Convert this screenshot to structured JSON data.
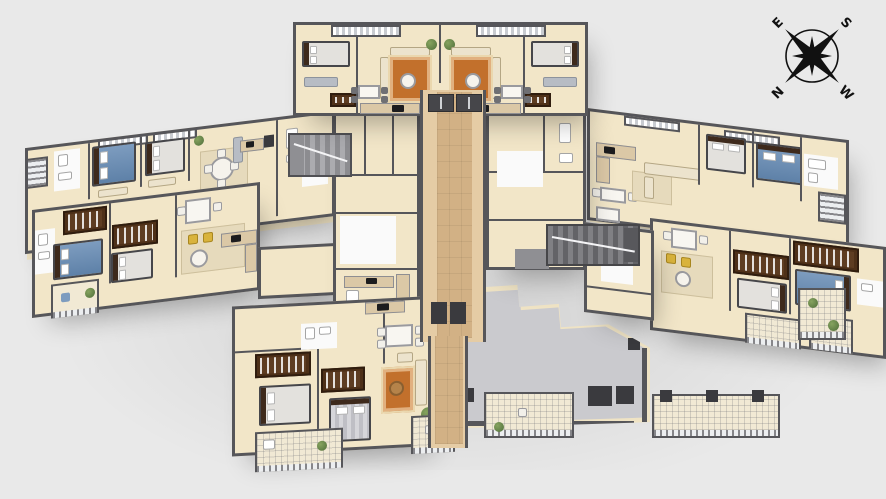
{
  "compass": {
    "north": "N",
    "east": "E",
    "south": "S",
    "west": "W"
  },
  "palette": {
    "bg": "#e9e9e9",
    "wall": "#56565a",
    "wall-dark": "#3a3a3e",
    "floor": "#f2e6c8",
    "corridor": "#e5cca5",
    "runner": "#d2b185",
    "terrace": "#cacace",
    "balcony": "#f1e9d4",
    "white-room": "#fafafa",
    "bed-blue": "#7d9cbf",
    "bed-blue-dark": "#5e81a8",
    "bed-white": "#e3e1dd",
    "wardrobe": "#4e3018",
    "rug": "#c2702c",
    "sofa": "#ece3cd",
    "plant": "#4f6e3a",
    "chair-yellow": "#d9b33c",
    "compass-ink": "#111111"
  },
  "building": {
    "wings": [
      "top-wing",
      "upper-left-wing",
      "lower-left-wing",
      "right-upper-wing",
      "right-lower-wing",
      "bottom-wing",
      "terrace"
    ],
    "core_elements": [
      "central-corridor",
      "staircase-left",
      "staircase-right",
      "elevators",
      "balconies"
    ]
  }
}
